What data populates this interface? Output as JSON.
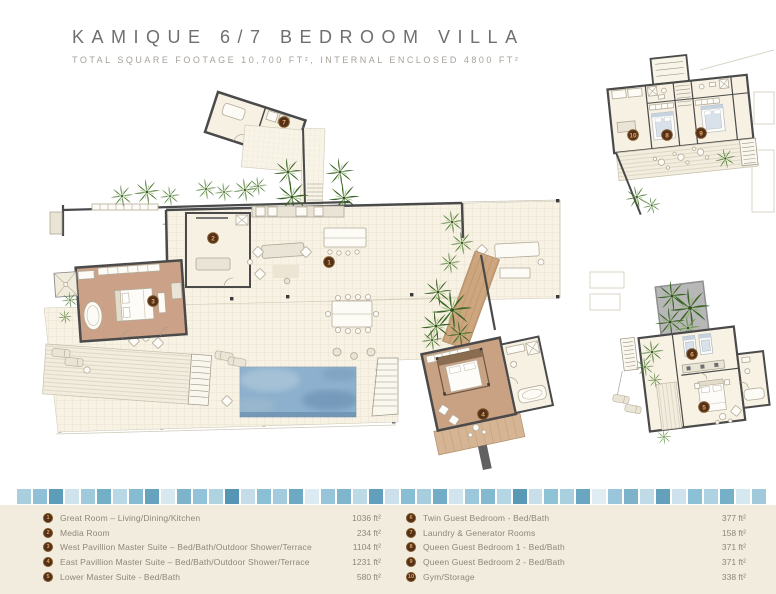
{
  "header": {
    "title": "KAMIQUE 6/7 BEDROOM VILLA",
    "subtitle": "TOTAL SQUARE FOOTAGE 10,700 FT², INTERNAL ENCLOSED 4800 FT²"
  },
  "plan": {
    "badges": [
      {
        "n": "1"
      },
      {
        "n": "2"
      },
      {
        "n": "3"
      },
      {
        "n": "4"
      },
      {
        "n": "5"
      },
      {
        "n": "6"
      },
      {
        "n": "7"
      },
      {
        "n": "8"
      },
      {
        "n": "9"
      },
      {
        "n": "10"
      }
    ]
  },
  "legend": {
    "columns": [
      {
        "items": [
          {
            "n": "1",
            "label": "Great Room – Living/Dining/Kitchen",
            "value": "1036 ft²"
          },
          {
            "n": "2",
            "label": "Media Room",
            "value": "234 ft²"
          },
          {
            "n": "3",
            "label": "West Pavillion Master Suite –  Bed/Bath/Outdoor Shower/Terrace",
            "value": "1104 ft²"
          },
          {
            "n": "4",
            "label": "East Pavillion Master Suite – Bed/Bath/Outdoor Shower/Terrace",
            "value": "1231 ft²"
          },
          {
            "n": "5",
            "label": "Lower Master Suite - Bed/Bath",
            "value": "580 ft²"
          }
        ]
      },
      {
        "items": [
          {
            "n": "6",
            "label": "Twin Guest Bedroom - Bed/Bath",
            "value": "377 ft²"
          },
          {
            "n": "7",
            "label": "Laundry & Generator Rooms",
            "value": "158 ft²"
          },
          {
            "n": "8",
            "label": "Queen Guest Bedroom 1 - Bed/Bath",
            "value": "371 ft²"
          },
          {
            "n": "9",
            "label": "Queen Guest Bedroom 2 - Bed/Bath",
            "value": "371 ft²"
          },
          {
            "n": "10",
            "label": "Gym/Storage",
            "value": "338 ft²"
          }
        ]
      }
    ]
  },
  "tiles": {
    "colors": [
      "#a9cede",
      "#8fc0d6",
      "#5e9dba",
      "#cfe3ec",
      "#9fcadc",
      "#74afc8",
      "#b9d8e5",
      "#86bcd2",
      "#67a3bf",
      "#d7e8ef",
      "#7db4cb",
      "#93c3d8",
      "#b0d3e2",
      "#5795b4",
      "#c4dde9",
      "#8abfd4",
      "#a2cbdd",
      "#6ea9c3",
      "#dcebf1",
      "#96c5d9",
      "#7fb6cd",
      "#bcd9e6",
      "#619fbc",
      "#cbe0eb",
      "#88bed3",
      "#a6cede",
      "#72acc6",
      "#d2e5ee",
      "#9bc8da",
      "#84bad0",
      "#b5d6e4",
      "#5a99b6",
      "#c8dfea",
      "#90c2d6",
      "#a9d0df",
      "#6aa6c1",
      "#dfedf2",
      "#99c6da",
      "#7cb3ca",
      "#bfdbe7",
      "#649fbb",
      "#cde2ec",
      "#8cc0d4",
      "#aed2e1",
      "#76b0c8",
      "#d5e7ef",
      "#a0c9db"
    ]
  },
  "colors": {
    "wall": "#4a4a4a",
    "floor_cream": "#f6f1e3",
    "wood": "#cba287",
    "pool": "#8cb0cd",
    "plant": "#4a7631",
    "badge_bg": "#53301a",
    "badge_text": "#e8a95c",
    "legend_bg": "#f1ecdd"
  }
}
